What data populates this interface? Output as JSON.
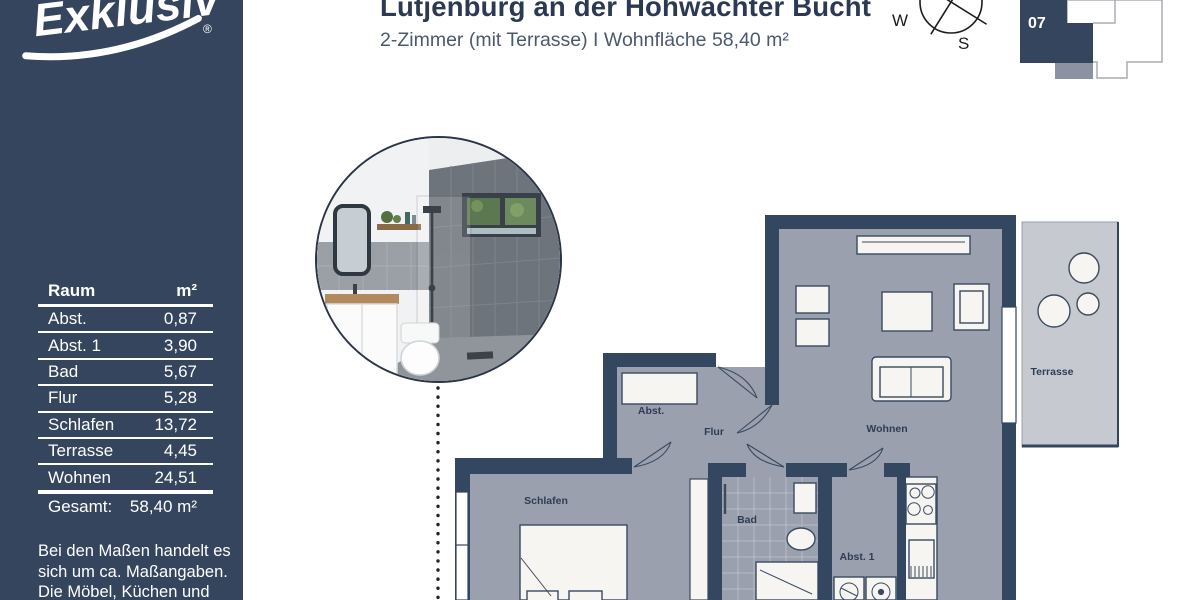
{
  "header": {
    "title": "Lütjenburg an der Hohwachter Bucht",
    "subtitle": "2-Zimmer (mit Terrasse) I Wohnfläche 58,40 m²"
  },
  "sidebar": {
    "logo": {
      "text": "Exklusiv",
      "registered": "®"
    },
    "table": {
      "col_room": "Raum",
      "col_area": "m²",
      "rows": [
        {
          "room": "Abst.",
          "area": "0,87"
        },
        {
          "room": "Abst. 1",
          "area": "3,90"
        },
        {
          "room": "Bad",
          "area": "5,67"
        },
        {
          "room": "Flur",
          "area": "5,28"
        },
        {
          "room": "Schlafen",
          "area": "13,72"
        },
        {
          "room": "Terrasse",
          "area": "4,45"
        },
        {
          "room": "Wohnen",
          "area": "24,51"
        }
      ],
      "total": {
        "label": "Gesamt:",
        "value": "58,40 m²"
      }
    },
    "disclaimer_lines": [
      "Bei den Maßen handelt es",
      "sich um ca. Maßangaben.",
      "Die Möbel, Küchen und",
      "Sanitärobjekte sind"
    ]
  },
  "compass": {
    "west": "W",
    "south": "S"
  },
  "site_plan": {
    "unit_number": "07"
  },
  "floor_plan": {
    "rooms": {
      "abst": "Abst.",
      "flur": "Flur",
      "wohnen": "Wohnen",
      "schlafen": "Schlafen",
      "bad": "Bad",
      "abst1": "Abst. 1",
      "terrasse": "Terrasse"
    }
  },
  "colors": {
    "sidebar_navy": "#35455e",
    "wall_navy": "#334760",
    "floor_gray": "#9aa0ad",
    "terrace_gray": "#c6c9cf",
    "title_navy": "#2b3a52"
  }
}
